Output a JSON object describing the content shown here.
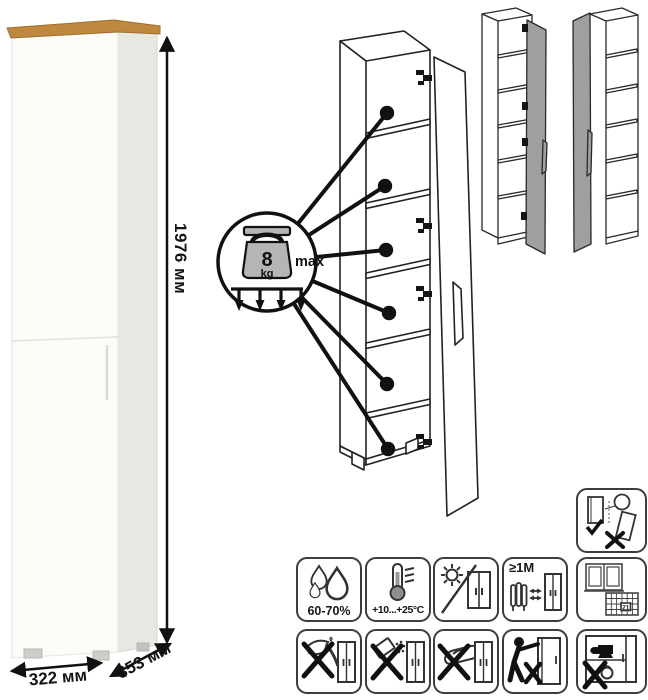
{
  "dimensions": {
    "height": "1976 мм",
    "width": "322 мм",
    "depth": "353 мм"
  },
  "load_callout": {
    "weight": "8",
    "unit": "kg",
    "max_label": "max"
  },
  "care_icons": {
    "humidity": {
      "name": "humidity-drops-icon",
      "label": "60-70%"
    },
    "temperature": {
      "name": "thermometer-icon",
      "label": "+10...+25°C"
    },
    "sunlight": {
      "name": "no-direct-sunlight-icon"
    },
    "heat_distance": {
      "name": "heat-distance-icon",
      "label": "≥1М"
    },
    "ventilation": {
      "name": "window-calendar-icon",
      "calendar_day": "21"
    },
    "sharp": {
      "name": "no-sharp-tools-icon"
    },
    "spill": {
      "name": "no-abrasives-icon"
    },
    "hot": {
      "name": "no-hot-objects-icon"
    },
    "drag": {
      "name": "no-dragging-icon"
    },
    "overload": {
      "name": "no-overload-icon"
    },
    "anchor": {
      "name": "anchor-to-wall-icon"
    }
  }
}
